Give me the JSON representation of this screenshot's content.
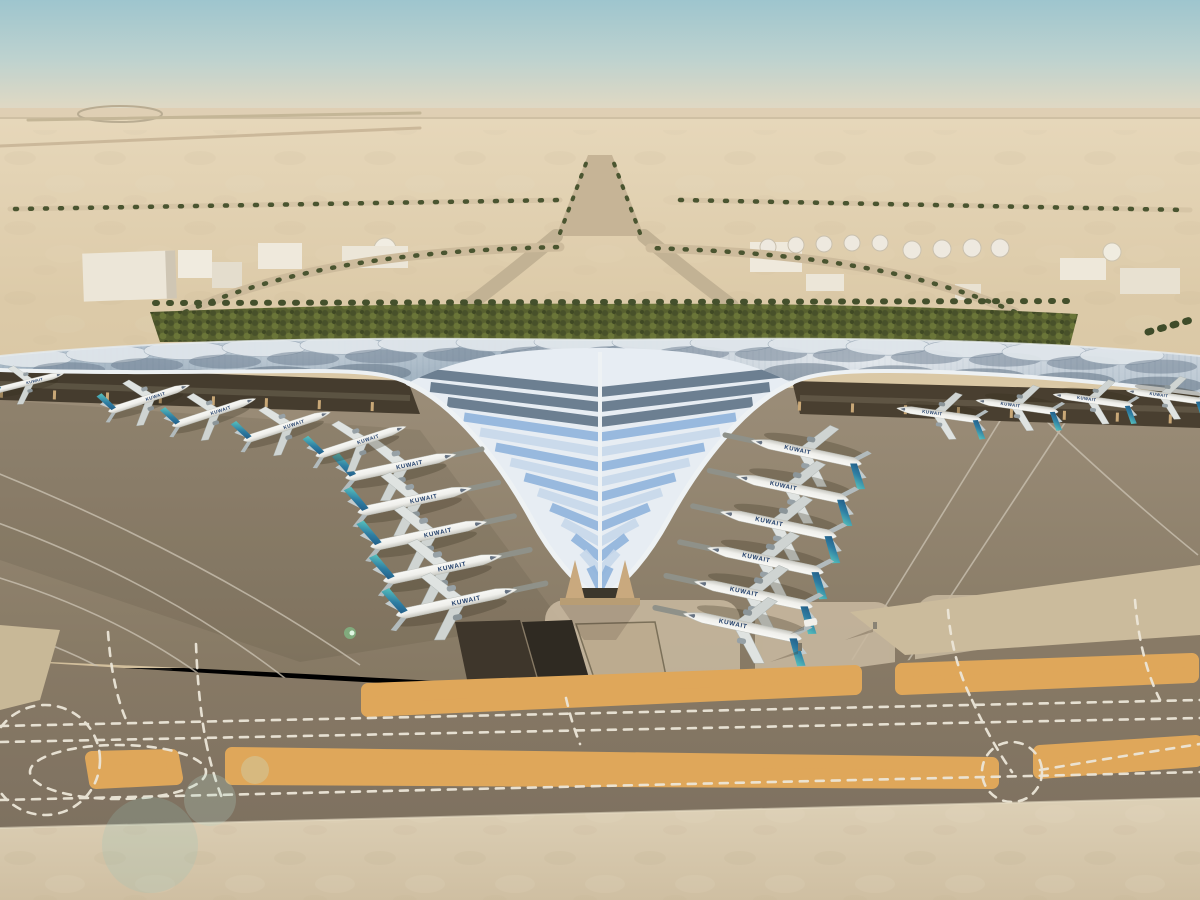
{
  "scene": {
    "alt": "Aerial rendering of a desert airport: trefoil swept canopy terminal with blue glazed roof, Kuwait Airways aircraft parked at gates, palm-lined approach roads, fuel tank farm, taxiways with dashed markings",
    "aircraft": {
      "livery": "KUWAIT",
      "fuselage_color": "#f3f3ef",
      "tail_color_base": "#1d4b78",
      "tail_color_tip": "#57c1bd",
      "count_visible": 20
    },
    "palette": {
      "sky_top": "#9ec5ce",
      "sky_horizon": "#e8dcc6",
      "desert": "#ddcba9",
      "foreground_concrete": "#d8cab0",
      "taxiway": "#857862",
      "sand_strip": "#dfa75a",
      "marking": "#ece6d8",
      "roof_silver": "#cfd7de",
      "roof_slate": "#5d6f80",
      "roof_glass_blue": "#8fb3dc",
      "canopy_fascia": "#eef2f4",
      "hedge_green": "#57602f",
      "apron": "#93866f"
    }
  },
  "aircraft_instances": [
    {
      "x": 402,
      "y": 466,
      "rot": -12,
      "s": 0.95,
      "bridge": 1
    },
    {
      "x": 416,
      "y": 500,
      "rot": -12,
      "s": 0.98,
      "bridge": 1
    },
    {
      "x": 430,
      "y": 534,
      "rot": -12,
      "s": 1.0,
      "bridge": 1
    },
    {
      "x": 444,
      "y": 568,
      "rot": -12,
      "s": 1.02,
      "bridge": 1
    },
    {
      "x": 458,
      "y": 602,
      "rot": -12,
      "s": 1.04,
      "bridge": 1
    },
    {
      "x": 805,
      "y": 452,
      "rot": 192,
      "s": 0.95,
      "bridge": 1
    },
    {
      "x": 791,
      "y": 488,
      "rot": 192,
      "s": 0.97,
      "bridge": 1
    },
    {
      "x": 777,
      "y": 524,
      "rot": 192,
      "s": 1.0,
      "bridge": 1
    },
    {
      "x": 764,
      "y": 560,
      "rot": 192,
      "s": 1.0,
      "bridge": 1
    },
    {
      "x": 752,
      "y": 594,
      "rot": 192,
      "s": 1.02,
      "bridge": 1
    },
    {
      "x": 741,
      "y": 626,
      "rot": 192,
      "s": 1.02,
      "bridge": 1
    },
    {
      "x": 150,
      "y": 398,
      "rot": -18,
      "s": 0.72
    },
    {
      "x": 215,
      "y": 412,
      "rot": -18,
      "s": 0.74
    },
    {
      "x": 288,
      "y": 426,
      "rot": -18,
      "s": 0.77
    },
    {
      "x": 362,
      "y": 441,
      "rot": -18,
      "s": 0.8
    },
    {
      "x": 30,
      "y": 382,
      "rot": -14,
      "s": 0.6
    },
    {
      "x": 938,
      "y": 414,
      "rot": 188,
      "s": 0.72
    },
    {
      "x": 1016,
      "y": 406,
      "rot": 188,
      "s": 0.7
    },
    {
      "x": 1092,
      "y": 400,
      "rot": 188,
      "s": 0.68
    },
    {
      "x": 1164,
      "y": 396,
      "rot": 188,
      "s": 0.66
    }
  ]
}
